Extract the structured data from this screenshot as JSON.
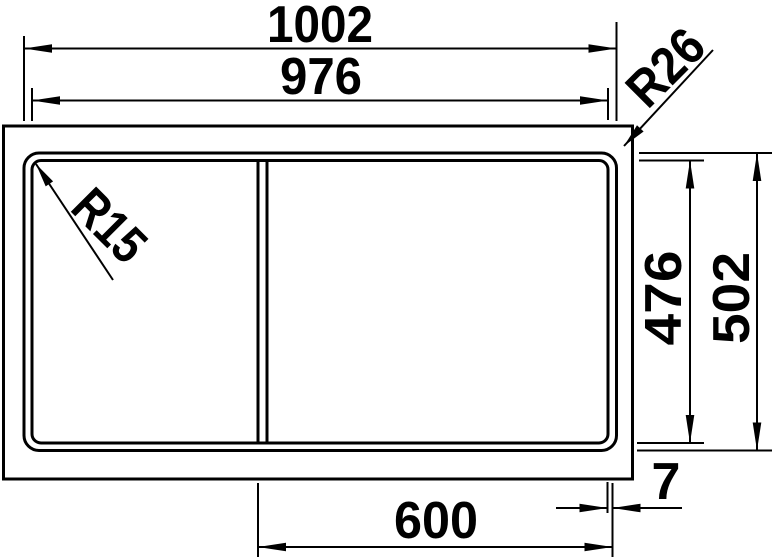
{
  "drawing": {
    "type": "technical-dimension-drawing",
    "subject": "sink-top-view",
    "background_color": "#ffffff",
    "line_color": "#000000",
    "labels": {
      "overall_width": "1002",
      "rim_width": "976",
      "rim_corner_radius": "R26",
      "bowl_corner_radius": "R15",
      "bowl_depth": "476",
      "overall_depth": "502",
      "right_bowl_width": "600",
      "edge_gap": "7"
    }
  }
}
